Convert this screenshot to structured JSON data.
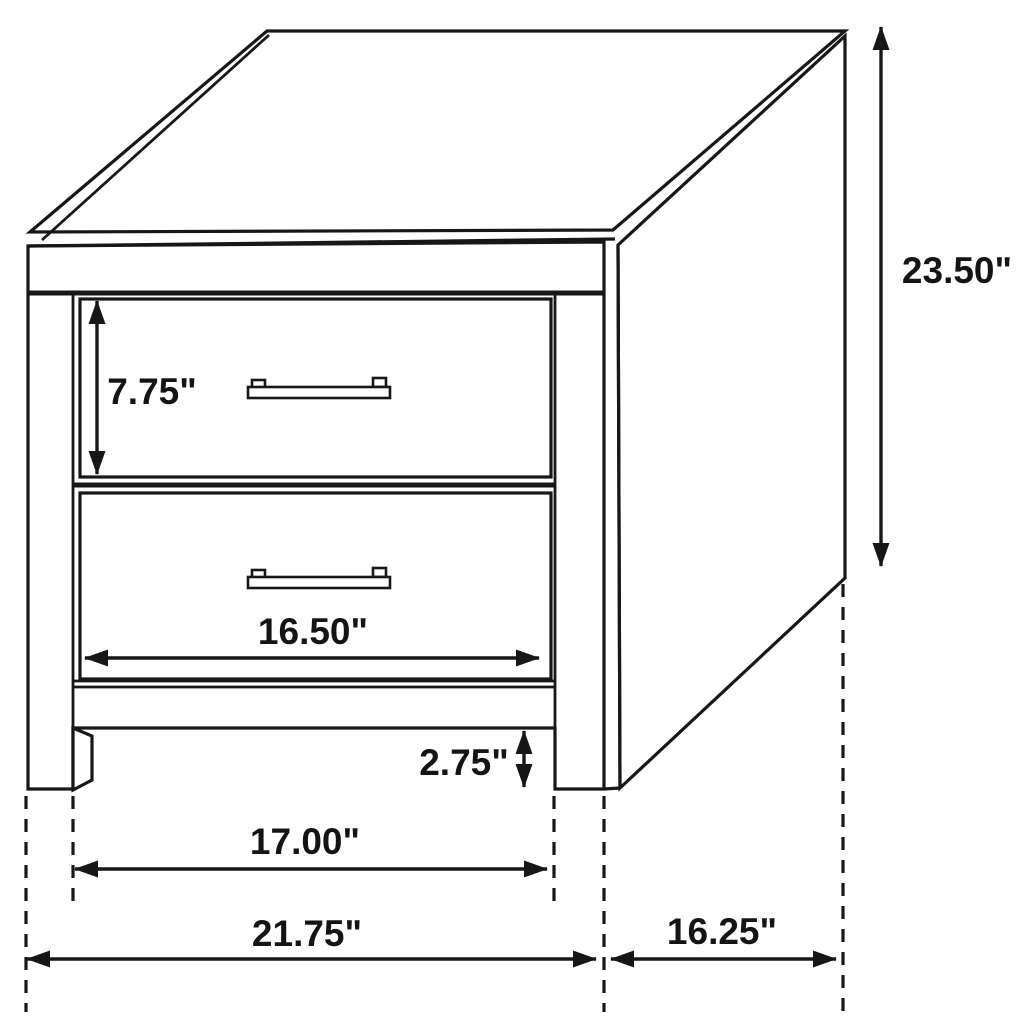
{
  "diagram": {
    "subject": "two-drawer nightstand dimension drawing"
  },
  "dimensions": {
    "overall_height": "23.50\"",
    "top_drawer_height": "7.75\"",
    "drawer_width": "16.50\"",
    "leg_height": "2.75\"",
    "width_between_legs": "17.00\"",
    "overall_width": "21.75\"",
    "overall_depth": "16.25\""
  },
  "colors": {
    "line": "#171717",
    "background": "#ffffff"
  }
}
